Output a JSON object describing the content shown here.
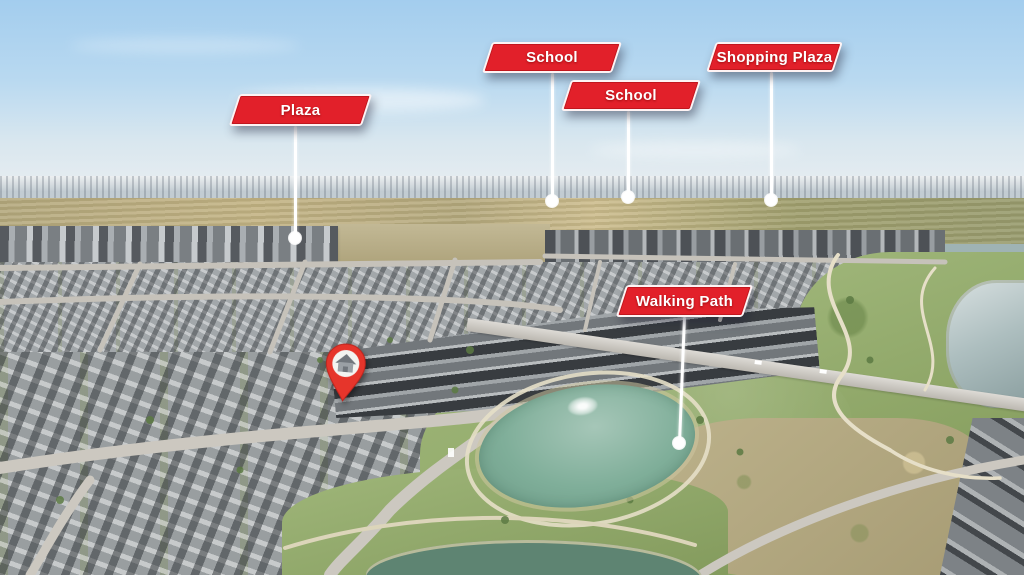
{
  "scene": {
    "type": "aerial-drone-photo",
    "description": "Aerial real-estate photo of a suburban community with labelled amenities, ponds and a highlighted home location",
    "colors": {
      "sky_top": "#a3cdee",
      "sky_horizon": "#e8edf0",
      "banner_red": "#e2202a",
      "banner_text": "#ffffff",
      "leader_line": "#ffffff",
      "pin_red": "#e6352b",
      "pin_icon_grey": "#70767c",
      "grass": "#92ac67",
      "pond_teal": "#7fae99",
      "pond_dark": "#5e8472",
      "right_pond_grey": "#9fb3b4",
      "road_grey": "#cbc7bf",
      "field_tan": "#b5a97e"
    }
  },
  "callouts": [
    {
      "id": "plaza",
      "label": "Plaza",
      "left": 234,
      "top": 94,
      "width": 133,
      "height": 32,
      "line": {
        "x1": 295,
        "y1": 126,
        "x2": 295,
        "y2": 238
      }
    },
    {
      "id": "school-1",
      "label": "School",
      "left": 487,
      "top": 42,
      "width": 130,
      "height": 31,
      "line": {
        "x1": 552,
        "y1": 73,
        "x2": 552,
        "y2": 201
      }
    },
    {
      "id": "school-2",
      "label": "School",
      "left": 566,
      "top": 80,
      "width": 130,
      "height": 31,
      "line": {
        "x1": 628,
        "y1": 111,
        "x2": 628,
        "y2": 197
      }
    },
    {
      "id": "shopping-plaza",
      "label": "Shopping Plaza",
      "left": 711,
      "top": 42,
      "width": 127,
      "height": 30,
      "line": {
        "x1": 771,
        "y1": 72,
        "x2": 771,
        "y2": 200
      }
    },
    {
      "id": "walking-path",
      "label": "Walking Path",
      "left": 621,
      "top": 285,
      "width": 127,
      "height": 32,
      "line": {
        "x1": 684,
        "y1": 317,
        "x2": 679,
        "y2": 443
      }
    }
  ],
  "pin": {
    "icon": "house-icon",
    "box": {
      "left": 321,
      "top": 342,
      "width": 48,
      "height": 62
    }
  }
}
